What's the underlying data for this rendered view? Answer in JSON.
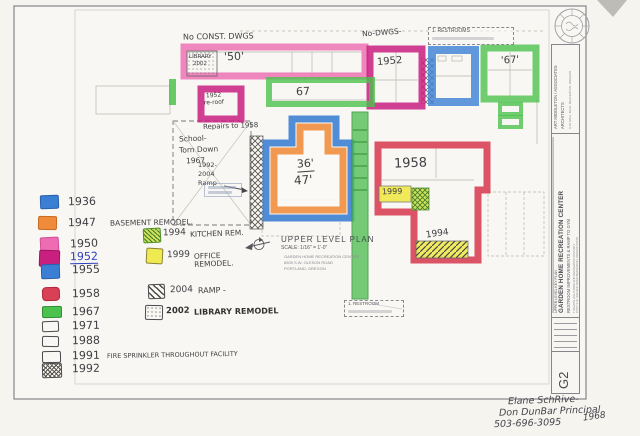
{
  "plan": {
    "note_no_const_dwgs": "No CONST. DWGS",
    "note_no_dwgs": "No-DWGS-",
    "library_box_line1": "LIBRARY",
    "library_box_line2": "2002",
    "dim_50": "'50'",
    "callout_restrooms_top": "1. RESTROOMS",
    "label_1952_top": "1952",
    "label_67_top": "'67'",
    "label_67_band": "67",
    "reroof_line1": "1952",
    "reroof_line2": "re-roof",
    "note_repairs": "Repairs to 1958",
    "school_line1": "School-",
    "school_line2": "Torn Down",
    "school_line3": "1967",
    "ramp_line1": "1992-",
    "ramp_line2": "2004",
    "ramp_line3": "Ramp",
    "gym_dim_top": "36'",
    "gym_dim_bottom": "47'",
    "label_1958": "1958",
    "label_1999": "1999",
    "label_1994": "1994",
    "callout_restroom_bottom": "1. RESTROOM",
    "title": "UPPER LEVEL PLAN",
    "scale": "SCALE: 1/16\" = 1'-0\"",
    "address_line1": "GARDEN HOME RECREATION CENTER",
    "address_line2": "6505 S.W. OLESON ROAD",
    "address_line3": "PORTLAND, OREGON"
  },
  "legend": {
    "left": [
      {
        "year": "1936",
        "note": ""
      },
      {
        "year": "1947",
        "note": "BASEMENT REMODEL."
      },
      {
        "year": "1950",
        "note": ""
      },
      {
        "year": "1952",
        "note": ""
      },
      {
        "year": "1955",
        "note": ""
      },
      {
        "year": "1958",
        "note": ""
      },
      {
        "year": "1967",
        "note": ""
      },
      {
        "year": "1971",
        "note": ""
      },
      {
        "year": "1988",
        "note": ""
      },
      {
        "year": "1991",
        "note": "FIRE SPRINKLER THROUGHOUT FACILITY"
      },
      {
        "year": "1992",
        "note": ""
      }
    ],
    "right": [
      {
        "year": "1994",
        "note": "KITCHEN REM."
      },
      {
        "year": "1999",
        "note": "OFFICE REMODEL."
      },
      {
        "year": "2004",
        "note": "RAMP -"
      },
      {
        "year": "2002",
        "note": "LIBRARY REMODEL"
      }
    ]
  },
  "titleblock": {
    "architect_name": "ART MIDDLETON / ASSOCIATES",
    "architect_title": "ARCHITECTS",
    "architect_address": "S.W. MALL BLVD.  BEAVERTON, OREGON",
    "sheet_label": "UPPER LEVEL KEY PLAN",
    "project_name": "GARDEN HOME RECREATION CENTER",
    "project_scope": "RESTROOM IMPROVEMENTS & RAMP TO GYM",
    "owner_line1": "TUALATIN HILLS PARK AND RECREATION DISTRICT",
    "owner_line2": "15707 S.W. WALKER ROAD  BEAVERTON, OREGON 97006",
    "sheet_number": "G2"
  },
  "handwritten_footer": {
    "line1": "Elane SchRive-",
    "line2": "Don DunBar  Principal",
    "line3": "503-696-3095",
    "line4": "1968"
  },
  "colors": {
    "pink": "#ee6db2",
    "magenta": "#c91f7f",
    "blue": "#3b7fd4",
    "green": "#4cc24e",
    "red": "#d84055",
    "orange": "#ef8b3a",
    "yellow": "#f0ea52",
    "yellow_green": "#cfe05a",
    "ink_blue": "#2f3fbf"
  }
}
